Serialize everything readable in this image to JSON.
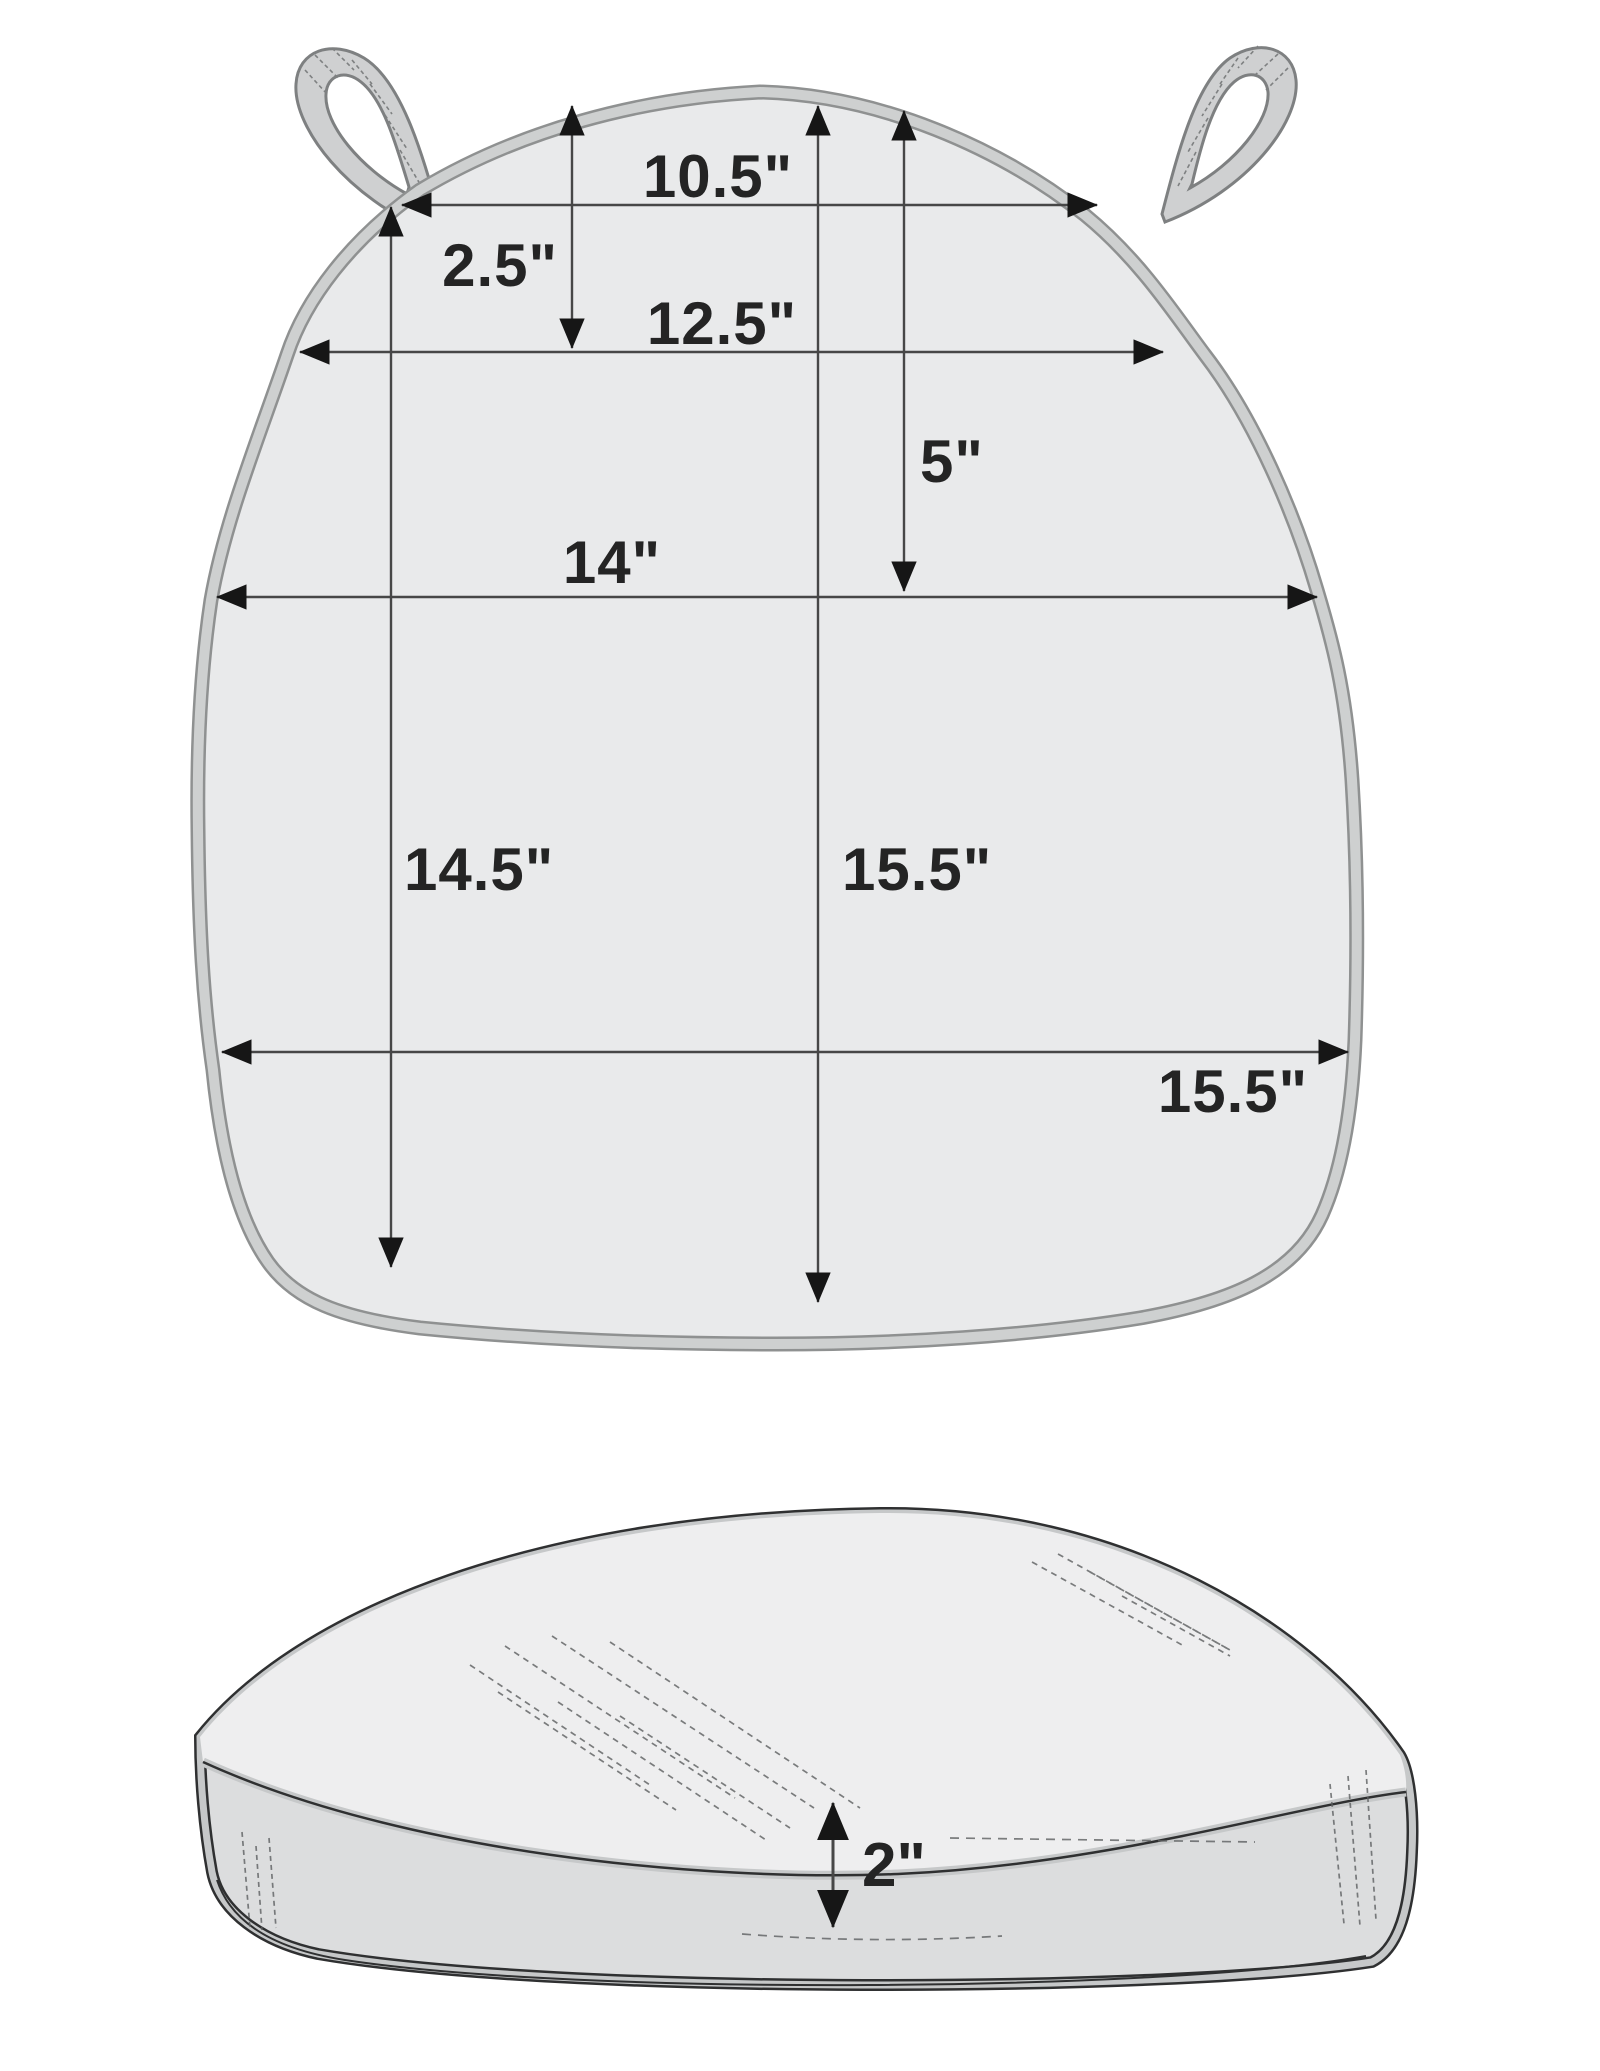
{
  "top_view": {
    "dims": {
      "top_width": "10.5\"",
      "strap_inset": "2.5\"",
      "upper_width": "12.5\"",
      "top_drop": "5\"",
      "middle_width": "14\"",
      "left_depth": "14.5\"",
      "center_depth": "15.5\"",
      "bottom_width": "15.5\""
    }
  },
  "side_view": {
    "dims": {
      "thickness": "2\""
    }
  },
  "colors": {
    "background": "#ffffff",
    "cushion_fill": "#e9eaeb",
    "piping_band": "#ced0d0",
    "piping_rim": "#8f9191",
    "strap_fill": "#cfd0d1",
    "strap_outline": "#7e8081",
    "dim_line": "#474747",
    "arrowhead": "#161616",
    "label_text": "#242424",
    "side_band_fill": "#dcddde",
    "side_dome_fill": "#eeeeef",
    "side_outline": "#2f3031",
    "side_piping": "#c6c8c9",
    "stitch": "#5d5f60"
  }
}
